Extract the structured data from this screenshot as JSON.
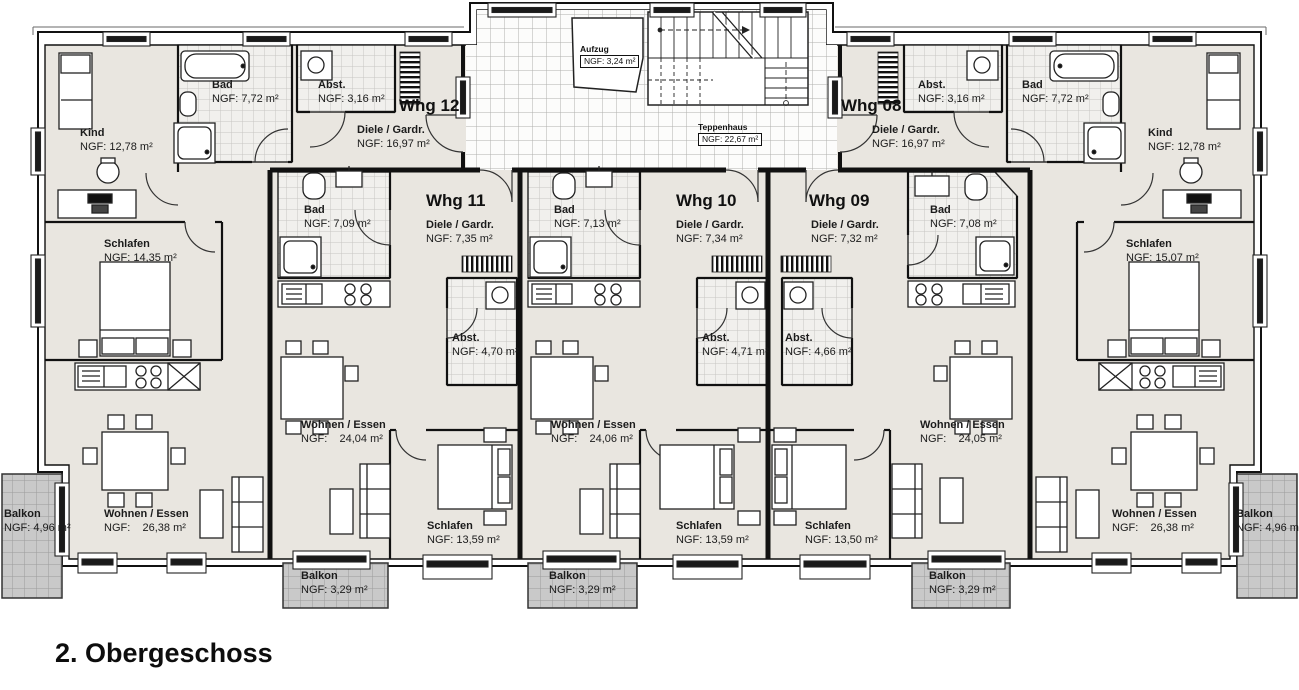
{
  "floor_title": "2. Obergeschoss",
  "core": {
    "aufzug": {
      "name": "Aufzug",
      "area": "NGF: 3,24 m²"
    },
    "treppenhaus": {
      "name": "Teppenhaus",
      "area": "NGF: 22,67 m²"
    }
  },
  "whg12": {
    "title": "Whg 12",
    "kind": {
      "name": "Kind",
      "area": "NGF: 12,78 m²"
    },
    "bad": {
      "name": "Bad",
      "area": "NGF: 7,72 m²"
    },
    "abst": {
      "name": "Abst.",
      "area": "NGF: 3,16 m²"
    },
    "diele": {
      "name": "Diele / Gardr.",
      "area": "NGF: 16,97 m²"
    },
    "schlafen": {
      "name": "Schlafen",
      "area": "NGF: 14,35 m²"
    },
    "wohnen": {
      "name": "Wohnen / Essen",
      "area": "NGF:    26,38 m²"
    },
    "balkon": {
      "name": "Balkon",
      "area": "NGF: 4,96 m²"
    }
  },
  "whg11": {
    "title": "Whg 11",
    "bad": {
      "name": "Bad",
      "area": "NGF: 7,09 m²"
    },
    "diele": {
      "name": "Diele / Gardr.",
      "area": "NGF: 7,35 m²"
    },
    "abst": {
      "name": "Abst.",
      "area": "NGF: 4,70 m²"
    },
    "wohnen": {
      "name": "Wohnen / Essen",
      "area": "NGF:    24,04 m²"
    },
    "schlafen": {
      "name": "Schlafen",
      "area": "NGF: 13,59 m²"
    },
    "balkon": {
      "name": "Balkon",
      "area": "NGF: 3,29 m²"
    }
  },
  "whg10": {
    "title": "Whg 10",
    "bad": {
      "name": "Bad",
      "area": "NGF: 7,13 m²"
    },
    "diele": {
      "name": "Diele / Gardr.",
      "area": "NGF: 7,34 m²"
    },
    "abst": {
      "name": "Abst.",
      "area": "NGF: 4,71 m²"
    },
    "wohnen": {
      "name": "Wohnen / Essen",
      "area": "NGF:    24,06 m²"
    },
    "schlafen": {
      "name": "Schlafen",
      "area": "NGF: 13,59 m²"
    },
    "balkon": {
      "name": "Balkon",
      "area": "NGF: 3,29 m²"
    }
  },
  "whg09": {
    "title": "Whg 09",
    "diele": {
      "name": "Diele / Gardr.",
      "area": "NGF: 7,32 m²"
    },
    "abst": {
      "name": "Abst.",
      "area": "NGF: 4,66 m²"
    },
    "bad": {
      "name": "Bad",
      "area": "NGF: 7,08 m²"
    },
    "wohnen": {
      "name": "Wohnen / Essen",
      "area": "NGF:    24,05 m²"
    },
    "schlafen": {
      "name": "Schlafen",
      "area": "NGF: 13,50 m²"
    },
    "balkon": {
      "name": "Balkon",
      "area": "NGF: 3,29 m²"
    }
  },
  "whg08": {
    "title": "Whg 08",
    "diele": {
      "name": "Diele / Gardr.",
      "area": "NGF: 16,97 m²"
    },
    "abst": {
      "name": "Abst.",
      "area": "NGF: 3,16 m²"
    },
    "bad": {
      "name": "Bad",
      "area": "NGF: 7,72 m²"
    },
    "kind": {
      "name": "Kind",
      "area": "NGF: 12,78 m²"
    },
    "schlafen": {
      "name": "Schlafen",
      "area": "NGF: 15,07 m²"
    },
    "wohnen": {
      "name": "Wohnen / Essen",
      "area": "NGF:    26,38 m²"
    },
    "balkon": {
      "name": "Balkon",
      "area": "NGF: 4,96 m²"
    }
  }
}
